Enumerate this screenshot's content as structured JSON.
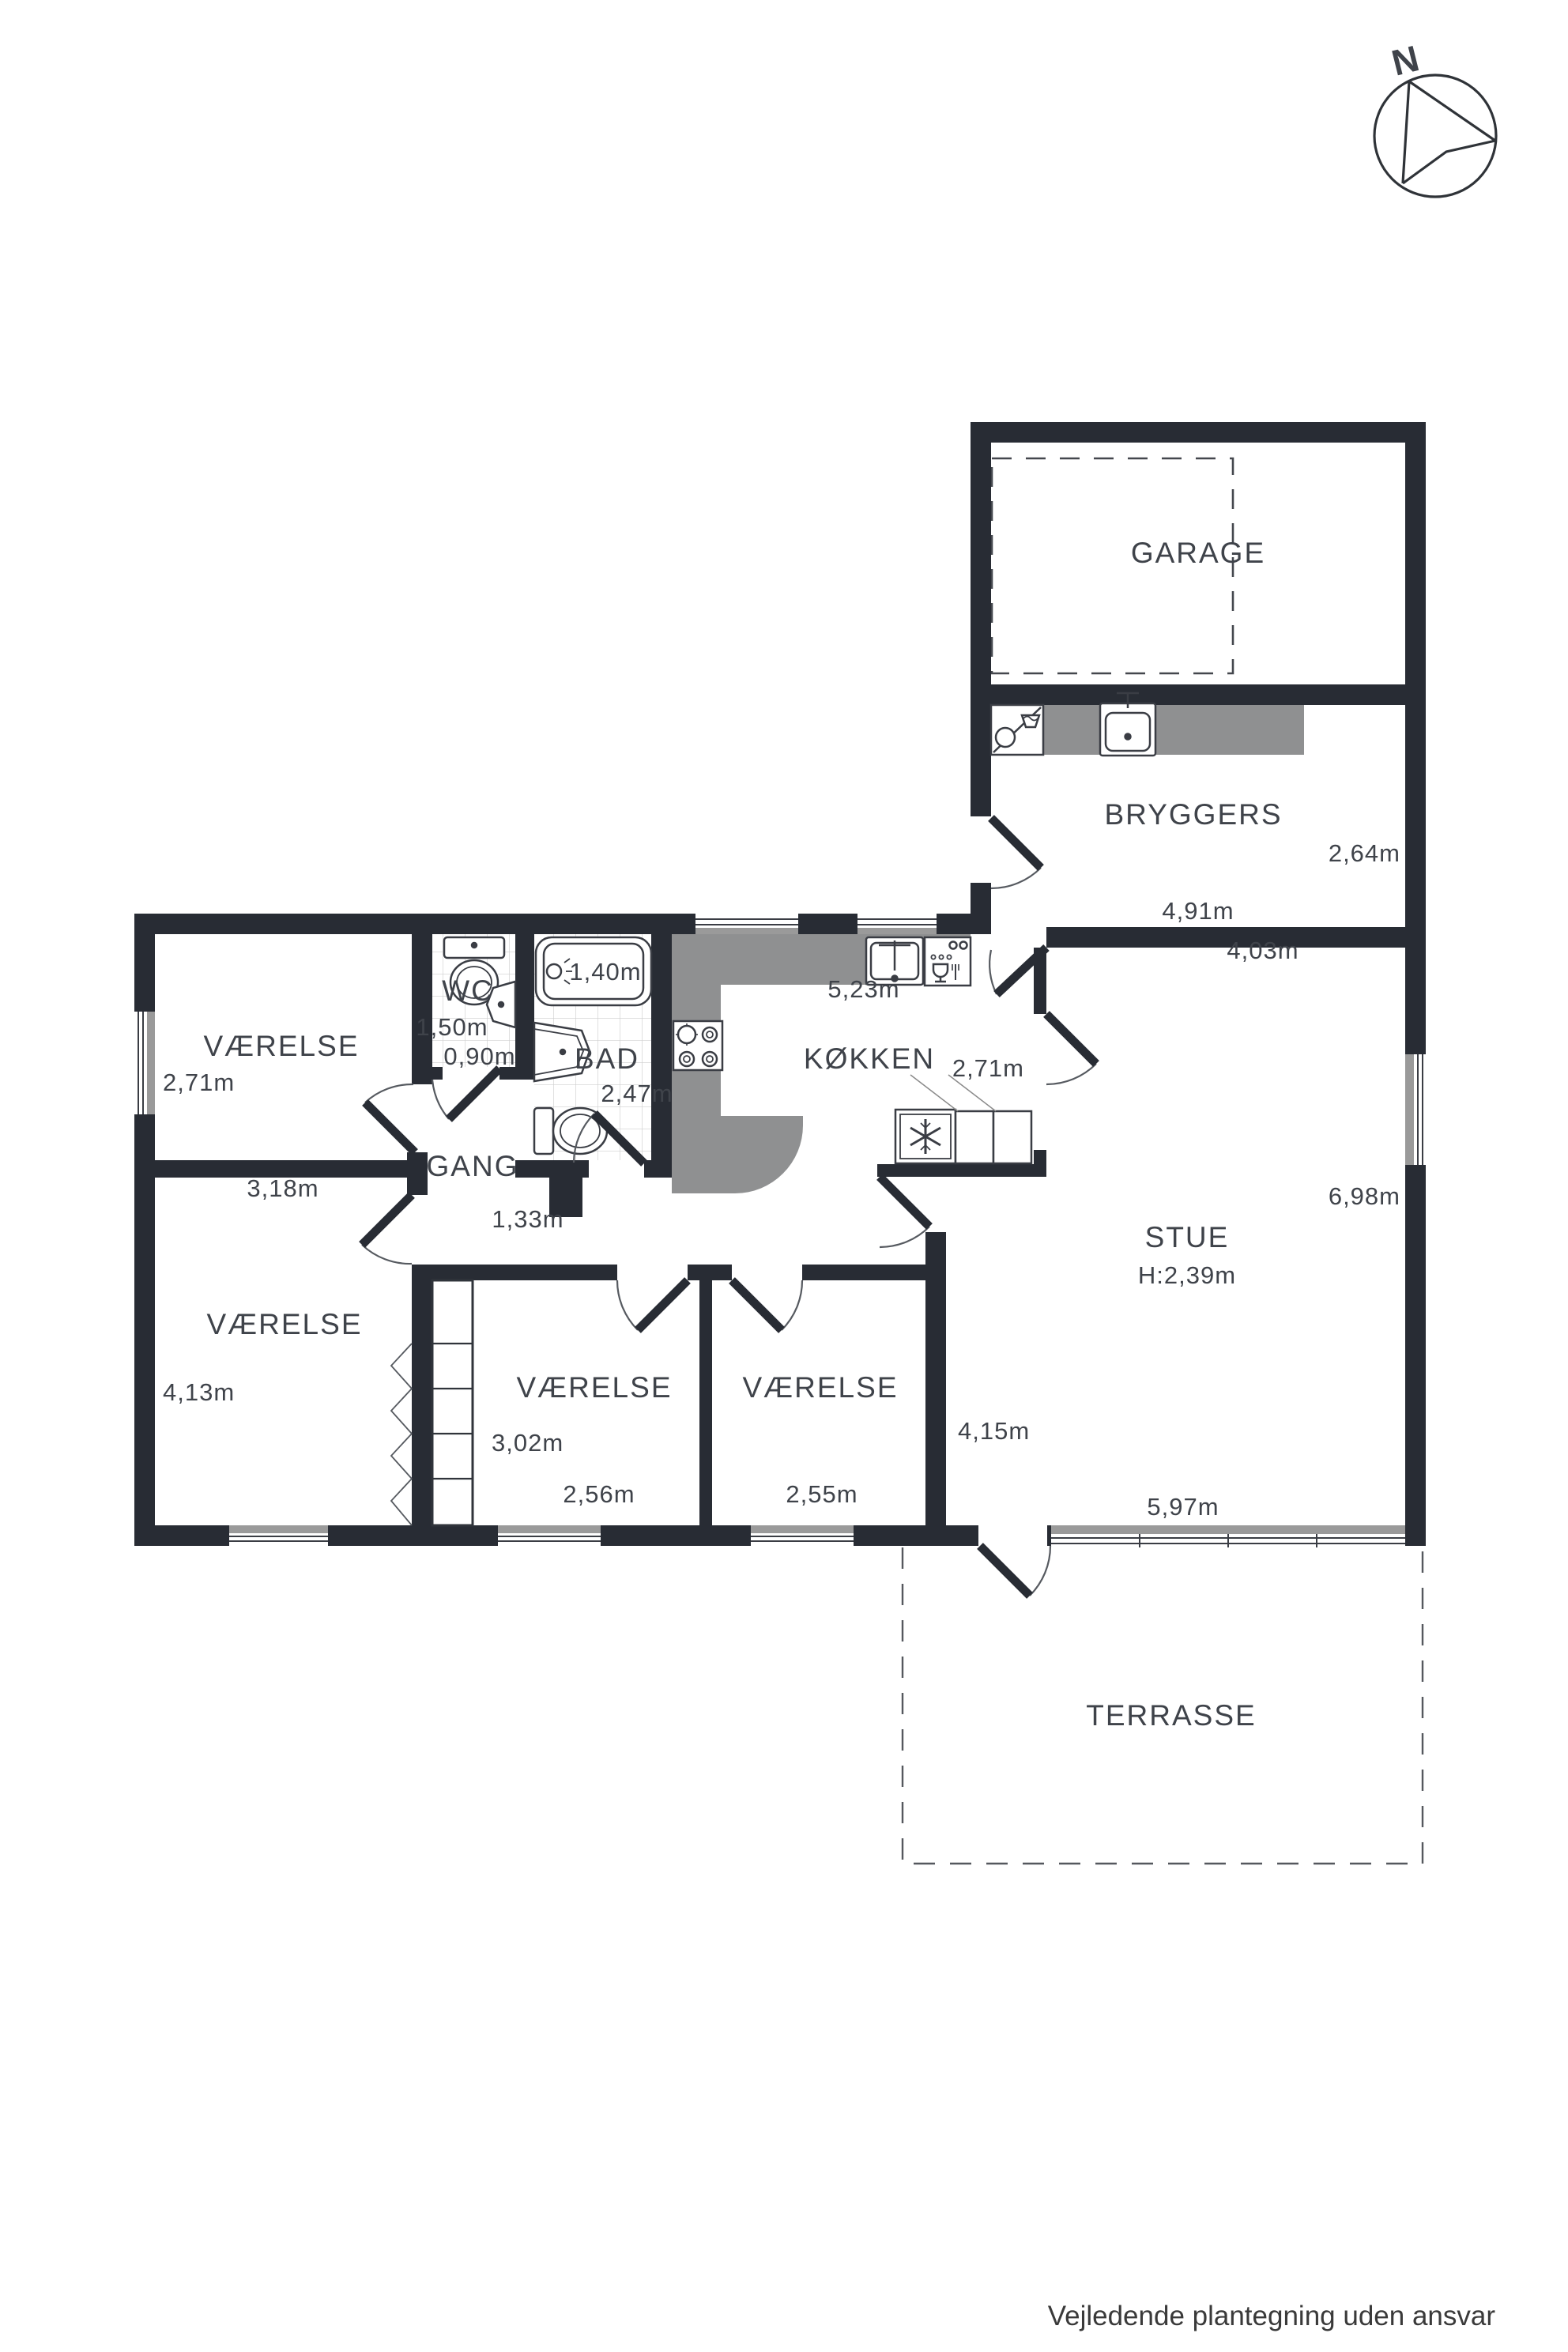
{
  "title": "Floor plan (plantegning)",
  "footer": {
    "disclaimer": "Vejledende plantegning uden ansvar"
  },
  "compass": {
    "label": "N"
  },
  "rooms": {
    "garage": {
      "label": "GARAGE"
    },
    "bryggers": {
      "label": "BRYGGERS",
      "width": "4,91m",
      "depth": "2,64m"
    },
    "kokken": {
      "label": "KØKKEN",
      "width": "5,23m",
      "door_opening": "2,71m"
    },
    "stue": {
      "label": "STUE",
      "ceiling_height": "H:2,39m",
      "top_width": "4,03m",
      "side_height": "6,98m",
      "bottom_width": "5,97m",
      "west_height": "4,15m"
    },
    "gang": {
      "label": "GANG",
      "width": "1,33m"
    },
    "wc": {
      "label": "WC",
      "length": "1,50m",
      "width": "0,90m"
    },
    "bad": {
      "label": "BAD",
      "depth": "2,47m",
      "tub_length": "1,40m"
    },
    "vaerelse_nw": {
      "label": "VÆRELSE",
      "side": "2,71m",
      "bottom": "3,18m"
    },
    "vaerelse_sw": {
      "label": "VÆRELSE",
      "side": "4,13m"
    },
    "vaerelse_s1": {
      "label": "VÆRELSE",
      "side": "3,02m",
      "bottom": "2,56m"
    },
    "vaerelse_s2": {
      "label": "VÆRELSE",
      "bottom": "2,55m"
    },
    "terrasse": {
      "label": "TERRASSE"
    }
  },
  "colors": {
    "wall": "#282c34",
    "counter": "#8f9091",
    "window_gray": "#9a9a9a",
    "tile_line": "#cfcfcf",
    "text": "#3f434a"
  }
}
